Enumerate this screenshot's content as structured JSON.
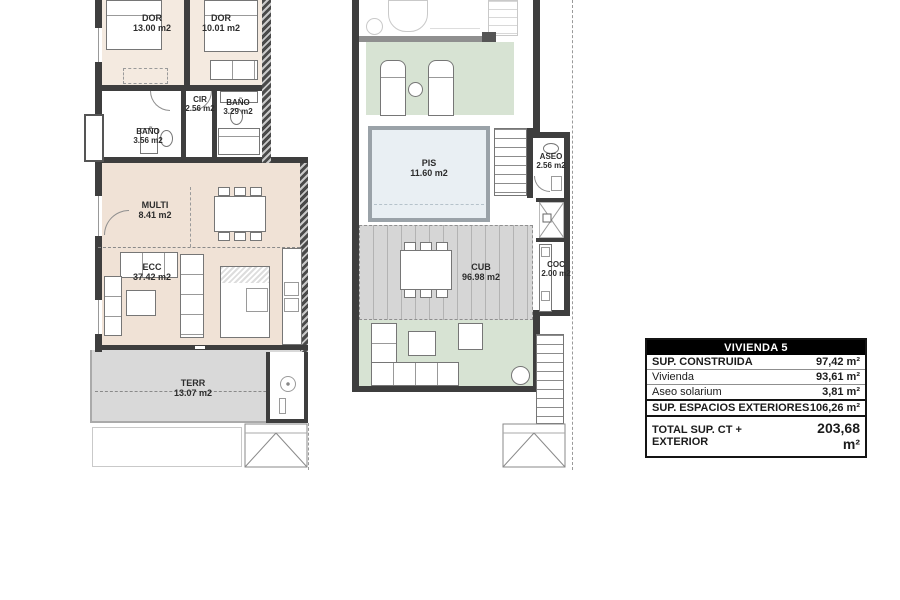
{
  "sheet": {
    "name": "floor-plan-vivienda-5"
  },
  "plans": {
    "apartment": {
      "rooms": {
        "dor1": {
          "name": "DOR",
          "area": "13.00 m2"
        },
        "dor2": {
          "name": "DOR",
          "area": "10.01 m2"
        },
        "cir": {
          "name": "CIR",
          "area": "2.56 m2"
        },
        "bano2": {
          "name": "BAÑO",
          "area": "3.29 m2"
        },
        "bano1": {
          "name": "BAÑO",
          "area": "3.56 m2"
        },
        "multi": {
          "name": "MULTI",
          "area": "8.41 m2"
        },
        "ecc": {
          "name": "ECC",
          "area": "37.42 m2"
        },
        "terr": {
          "name": "TERR",
          "area": "13.07 m2"
        }
      }
    },
    "solarium": {
      "rooms": {
        "pis": {
          "name": "PIS",
          "area": "11.60 m2"
        },
        "aseo": {
          "name": "ASEO",
          "area": "2.56 m2"
        },
        "cub": {
          "name": "CUB",
          "area": "96.98 m2"
        },
        "coc": {
          "name": "COC",
          "area": "2.00 m2"
        }
      }
    }
  },
  "summary_table": {
    "header": "VIVIENDA 5",
    "rows": [
      {
        "label": "SUP. CONSTRUIDA",
        "value": "97,42 m²"
      },
      {
        "label": "Vivienda",
        "value": "93,61 m²"
      },
      {
        "label": "Aseo solarium",
        "value": "3,81 m²"
      },
      {
        "label": "SUP. ESPACIOS EXTERIORES",
        "value": "106,26 m²"
      },
      {
        "label": "TOTAL SUP. CT + EXTERIOR",
        "value": "203,68 m²"
      }
    ]
  },
  "colors": {
    "wall": "#3e3e3e",
    "floor_bedroom": "#f4eae0",
    "floor_living": "#f0e2d6",
    "floor_terrace": "#d9d9d9",
    "floor_cub": "#d6d6d6",
    "grass": "#d7e3d3",
    "pool_water": "#e9eff3",
    "table_header_bg": "#000000",
    "table_header_text": "#ffffff"
  }
}
